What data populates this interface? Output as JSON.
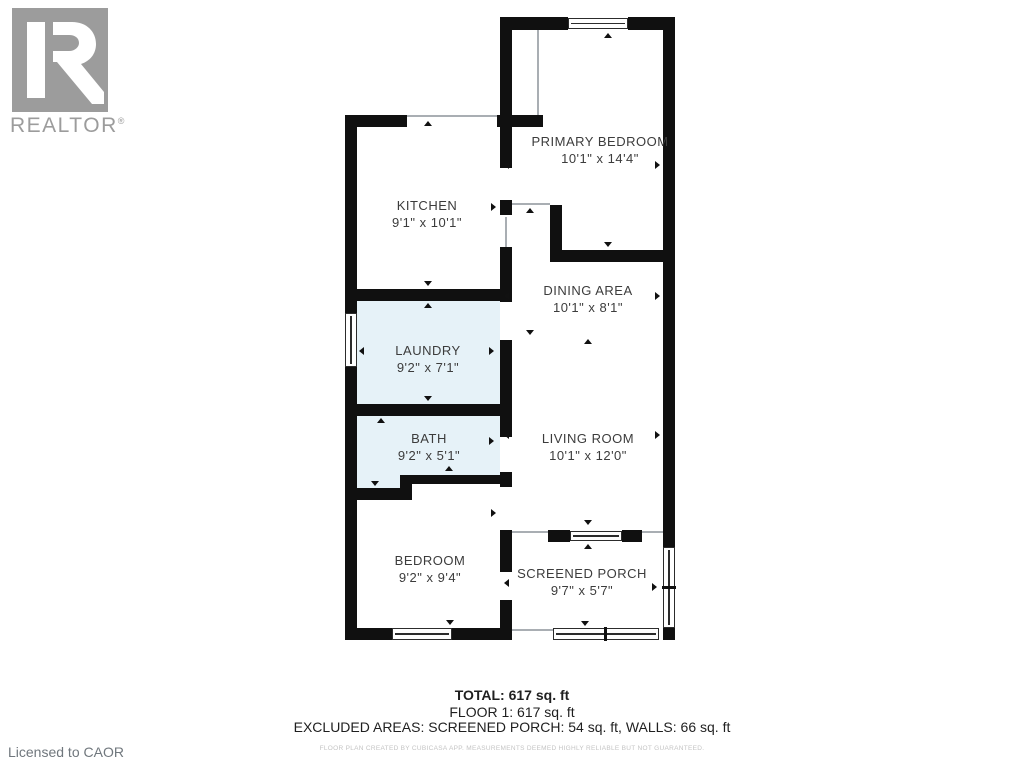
{
  "branding": {
    "logo_text": "REALTOR",
    "logo_reg": "®",
    "license_text": "Licensed to CAOR"
  },
  "rooms": [
    {
      "name": "KITCHEN",
      "dims": "9'1\" x 10'1\""
    },
    {
      "name": "PRIMARY BEDROOM",
      "dims": "10'1\" x 14'4\""
    },
    {
      "name": "DINING AREA",
      "dims": "10'1\" x 8'1\""
    },
    {
      "name": "LAUNDRY",
      "dims": "9'2\" x 7'1\"",
      "highlighted": true
    },
    {
      "name": "BATH",
      "dims": "9'2\" x 5'1\"",
      "highlighted": true
    },
    {
      "name": "LIVING ROOM",
      "dims": "10'1\" x 12'0\""
    },
    {
      "name": "BEDROOM",
      "dims": "9'2\" x 9'4\""
    },
    {
      "name": "SCREENED PORCH",
      "dims": "9'7\" x 5'7\""
    }
  ],
  "summary": {
    "total": "TOTAL: 617 sq. ft",
    "floor": "FLOOR 1: 617 sq. ft",
    "excluded": "EXCLUDED AREAS: SCREENED PORCH: 54 sq. ft, WALLS: 66 sq. ft",
    "disclaimer": "FLOOR PLAN CREATED BY CUBICASA APP. MEASUREMENTS DEEMED HIGHLY RELIABLE BUT NOT GUARANTEED."
  },
  "colors": {
    "wall": "#101010",
    "wet_room_fill": "#e6f2f8",
    "room_text": "#3c3c3c",
    "logo_gray": "#9c9c9c",
    "disclaimer_gray": "#c4c4c4"
  }
}
